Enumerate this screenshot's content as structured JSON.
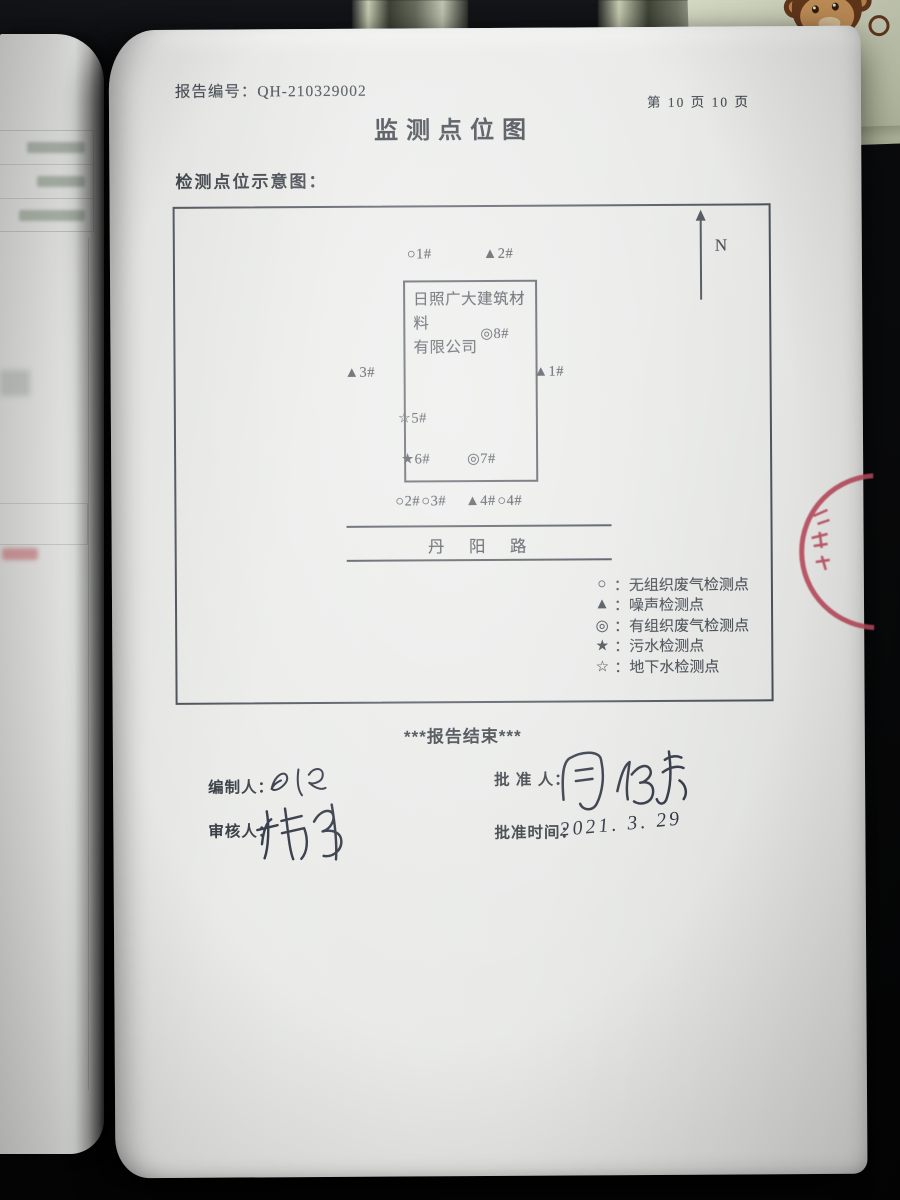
{
  "document": {
    "report_no_label": "报告编号：",
    "report_no_value": "QH-210329002",
    "page_indicator": "第 10 页 10 页",
    "title": "监测点位图",
    "section_heading": "检测点位示意图："
  },
  "diagram": {
    "north_label": "N",
    "company": {
      "line1": "日照广大建筑材料",
      "line2": "有限公司"
    },
    "road_name": "丹　阳　路",
    "points": [
      {
        "text": "○1#"
      },
      {
        "text": "▲2#"
      },
      {
        "text": "◎8#"
      },
      {
        "text": "▲3#"
      },
      {
        "text": "▲1#"
      },
      {
        "text": "☆5#"
      },
      {
        "text": "★6#"
      },
      {
        "text": "◎7#"
      },
      {
        "text": "○2#"
      },
      {
        "text": "○3#"
      },
      {
        "text": "▲4#"
      },
      {
        "text": "○4#"
      }
    ],
    "legend": [
      {
        "symbol": "○",
        "label": "：无组织废气检测点"
      },
      {
        "symbol": "▲",
        "label": "：噪声检测点"
      },
      {
        "symbol": "◎",
        "label": "：有组织废气检测点"
      },
      {
        "symbol": "★",
        "label": "：污水检测点"
      },
      {
        "symbol": "☆",
        "label": "：地下水检测点"
      }
    ]
  },
  "footer": {
    "end_marker": "***报告结束***",
    "prepared_by_label": "编制人：",
    "approved_by_label": "批 准 人：",
    "reviewed_by_label": "审核人：",
    "approval_time_label": "批准时间：",
    "approval_date_handwritten": "2021. 3. 29"
  },
  "surroundings": {
    "sticker_text": "刀刁"
  },
  "colors": {
    "stamp_red": "#b5485a",
    "ink": "#3d434b",
    "paper": "#e8e9e7"
  }
}
